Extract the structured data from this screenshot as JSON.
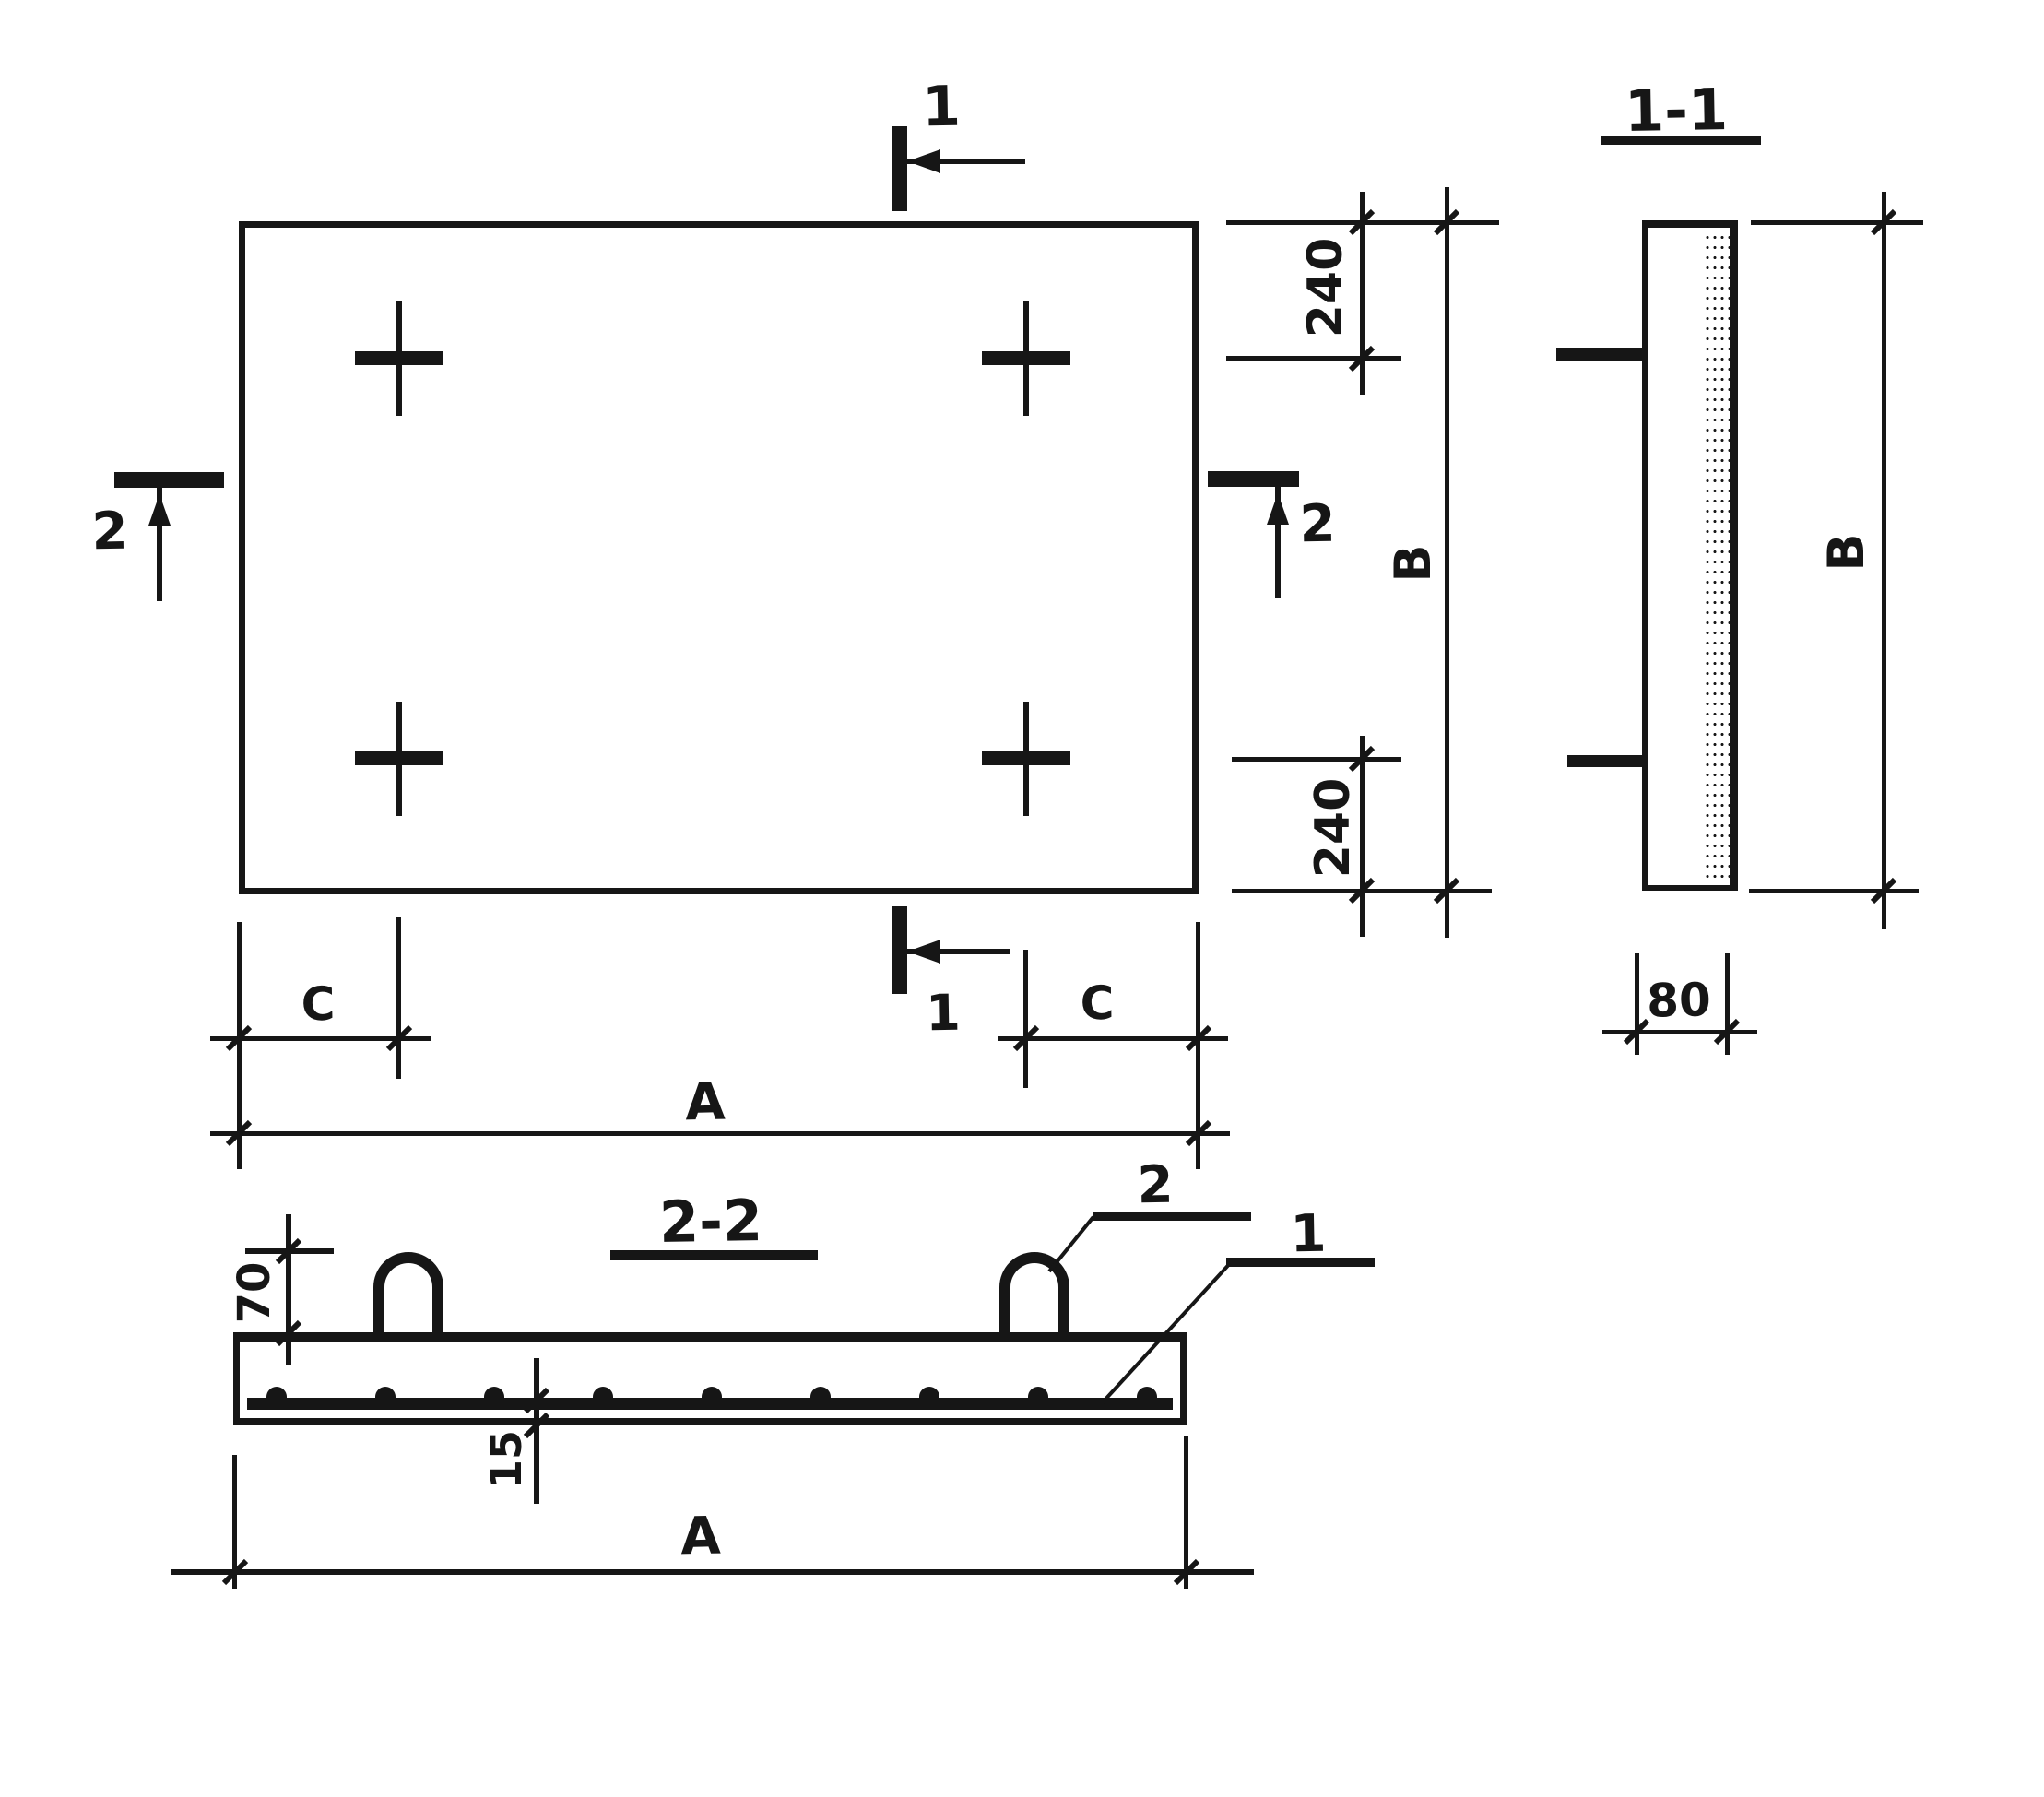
{
  "palette": {
    "ink": "#161616",
    "paper": "#ffffff"
  },
  "labels": {
    "cut1_top": "1",
    "cut1_bottom": "1",
    "cut2_left": "2",
    "cut2_right": "2",
    "dim240_top": "240",
    "dim240_bottom": "240",
    "dimB_plan": "B",
    "section11_title": "1-1",
    "dimB_section": "B",
    "dim80": "80",
    "section22_title": "2-2",
    "dim70": "70",
    "dim15": "15",
    "callout_loop": "2",
    "callout_mesh": "1",
    "dimC_left": "C",
    "dimC_right": "C",
    "dimA_plan": "A",
    "dimA_section": "A"
  }
}
